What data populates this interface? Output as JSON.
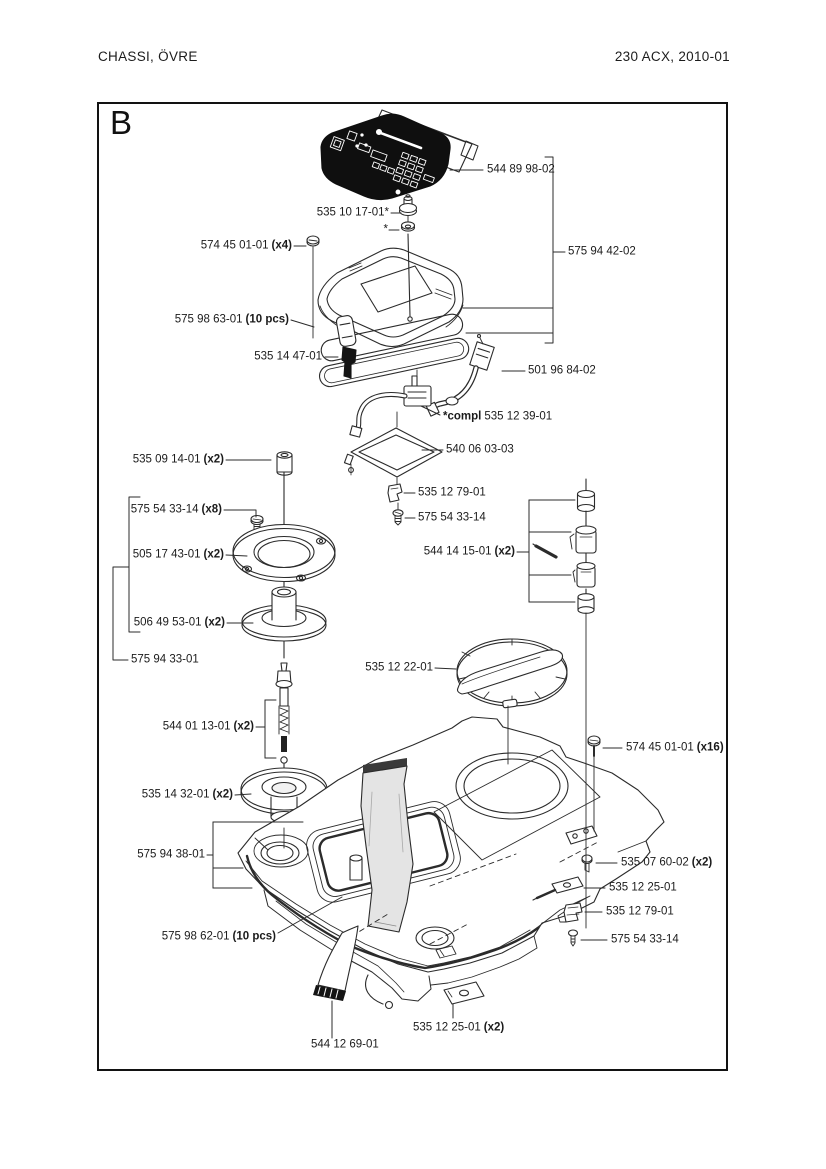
{
  "header": {
    "left": "CHASSI, ÖVRE",
    "right": "230 ACX, 2010-01"
  },
  "figure": {
    "letter": "B"
  },
  "labels": [
    {
      "name": "keypad-panel",
      "num": "544 89 98-02",
      "x": 487,
      "y": 170,
      "align": "left"
    },
    {
      "name": "contact-bolt",
      "num": "535 10 17-01*",
      "x": 389,
      "y": 213,
      "align": "right"
    },
    {
      "name": "washer-star",
      "num": "*",
      "x": 388,
      "y": 230,
      "align": "right"
    },
    {
      "name": "cover-assembly",
      "num": "575 94 42-02",
      "x": 568,
      "y": 252,
      "align": "left"
    },
    {
      "name": "screw-x4",
      "num": "574 45 01-01",
      "qty": "(x4)",
      "x": 292,
      "y": 246,
      "align": "right"
    },
    {
      "name": "seal-strip-top",
      "num": "575 98 63-01",
      "qty": "(10 pcs)",
      "x": 289,
      "y": 320,
      "align": "right"
    },
    {
      "name": "rubber-plug",
      "num": "535 14 47-01",
      "x": 322,
      "y": 357,
      "align": "right"
    },
    {
      "name": "cable",
      "num": "501 96 84-02",
      "x": 528,
      "y": 371,
      "align": "left"
    },
    {
      "name": "connector-compl",
      "prefix": "*compl",
      "num": "535 12 39-01",
      "x": 443,
      "y": 417,
      "align": "left"
    },
    {
      "name": "frame-plate",
      "num": "540 06 03-03",
      "x": 446,
      "y": 450,
      "align": "left"
    },
    {
      "name": "clip-upper",
      "num": "535 12 79-01",
      "x": 418,
      "y": 493,
      "align": "left"
    },
    {
      "name": "screw-upper",
      "num": "575 54 33-14",
      "x": 418,
      "y": 518,
      "align": "left"
    },
    {
      "name": "spacer",
      "num": "535 09 14-01",
      "qty": "(x2)",
      "x": 224,
      "y": 460,
      "align": "right"
    },
    {
      "name": "screw-x8",
      "num": "575 54 33-14",
      "qty": "(x8)",
      "x": 222,
      "y": 510,
      "align": "right"
    },
    {
      "name": "sealing-ring",
      "num": "505 17 43-01",
      "qty": "(x2)",
      "x": 224,
      "y": 555,
      "align": "right"
    },
    {
      "name": "bushing",
      "num": "506 49 53-01",
      "qty": "(x2)",
      "x": 225,
      "y": 623,
      "align": "right"
    },
    {
      "name": "ring-assembly",
      "num": "575 94 33-01",
      "x": 131,
      "y": 660,
      "align": "left"
    },
    {
      "name": "contact-kit",
      "num": "544 14 15-01",
      "qty": "(x2)",
      "x": 515,
      "y": 552,
      "align": "right"
    },
    {
      "name": "dial",
      "num": "535 12 22-01",
      "x": 433,
      "y": 668,
      "align": "right"
    },
    {
      "name": "antenna",
      "num": "544 01 13-01",
      "qty": "(x2)",
      "x": 254,
      "y": 727,
      "align": "right"
    },
    {
      "name": "grommet",
      "num": "535 14 32-01",
      "qty": "(x2)",
      "x": 233,
      "y": 795,
      "align": "right"
    },
    {
      "name": "chassis-assembly",
      "num": "575 94 38-01",
      "x": 205,
      "y": 855,
      "align": "right"
    },
    {
      "name": "screw-x16",
      "num": "574 45 01-01",
      "qty": "(x16)",
      "x": 626,
      "y": 748,
      "align": "left"
    },
    {
      "name": "screw-x2",
      "num": "535 07 60-02",
      "qty": "(x2)",
      "x": 621,
      "y": 863,
      "align": "left"
    },
    {
      "name": "strip",
      "num": "535 12 25-01",
      "x": 609,
      "y": 888,
      "align": "left"
    },
    {
      "name": "clip-lower",
      "num": "535 12 79-01",
      "x": 606,
      "y": 912,
      "align": "left"
    },
    {
      "name": "screw-lower",
      "num": "575 54 33-14",
      "x": 611,
      "y": 940,
      "align": "left"
    },
    {
      "name": "seal-strip-bottom",
      "num": "575 98 62-01",
      "qty": "(10 pcs)",
      "x": 276,
      "y": 937,
      "align": "right"
    },
    {
      "name": "plate-x2",
      "num": "535 12 25-01",
      "qty": "(x2)",
      "x": 413,
      "y": 1028,
      "align": "left"
    },
    {
      "name": "ribbon-cable",
      "num": "544 12 69-01",
      "x": 311,
      "y": 1045,
      "align": "left"
    }
  ]
}
